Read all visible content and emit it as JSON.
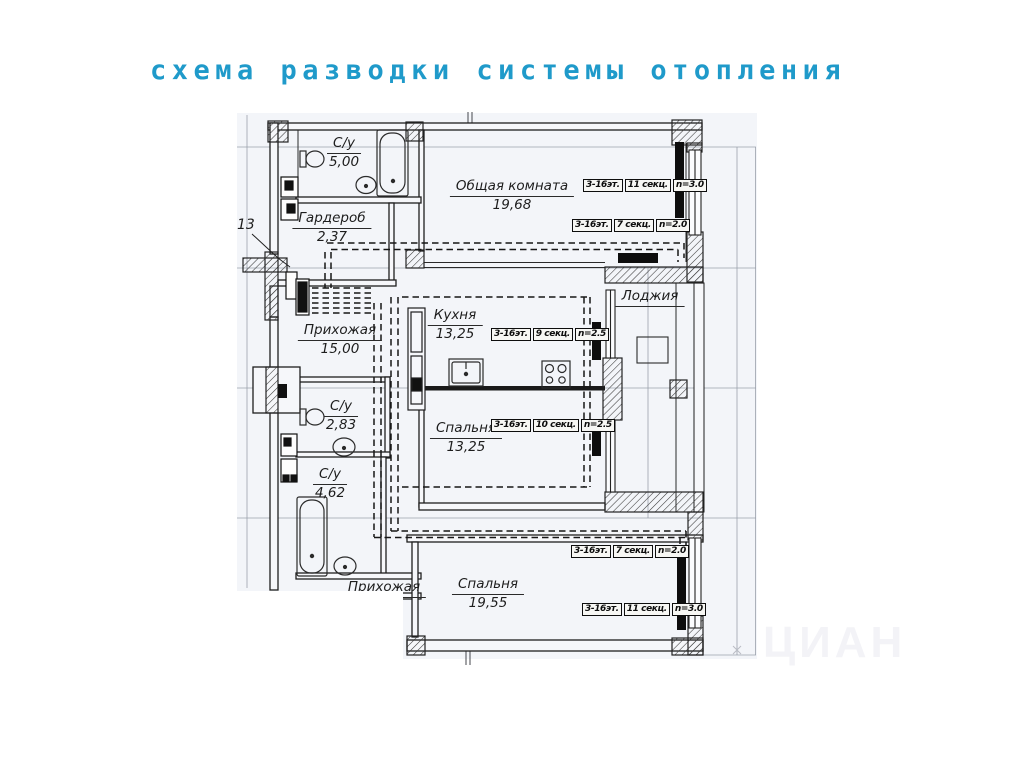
{
  "title": "схема разводки системы отопления",
  "colors": {
    "title_blue": "#1f9aca",
    "paper_tint": "#f3f5f9",
    "line_black": "#1e1e1e",
    "radiator_black": "#0d0d0d"
  },
  "plan": {
    "riser_label": "13",
    "watermark": "ЦИАН",
    "rooms": [
      {
        "name": "С/у",
        "area": "5,00"
      },
      {
        "name": "Гардероб",
        "area": "2,37"
      },
      {
        "name": "Общая комната",
        "area": "19,68"
      },
      {
        "name": "Прихожая",
        "area": "15,00"
      },
      {
        "name": "Кухня",
        "area": "13,25"
      },
      {
        "name": "С/у",
        "area": "2,83"
      },
      {
        "name": "С/у",
        "area": "4,62"
      },
      {
        "name": "Спальня",
        "area": "13,25"
      },
      {
        "name": "Лоджия",
        "area": ""
      },
      {
        "name": "Спальня",
        "area": "19,55"
      },
      {
        "name": "Прихожая",
        "area": ""
      }
    ],
    "radiators": [
      {
        "floors": "3-16эт.",
        "sections": "11 секц.",
        "power": "n=3.0"
      },
      {
        "floors": "3-16эт.",
        "sections": "7 секц.",
        "power": "n=2.0"
      },
      {
        "floors": "3-16эт.",
        "sections": "9 секц.",
        "power": "n=2.5"
      },
      {
        "floors": "3-16эт.",
        "sections": "10 секц.",
        "power": "n=2.5"
      },
      {
        "floors": "3-16эт.",
        "sections": "7 секц.",
        "power": "n=2.0"
      },
      {
        "floors": "3-16эт.",
        "sections": "11 секц.",
        "power": "n=3.0"
      }
    ]
  }
}
